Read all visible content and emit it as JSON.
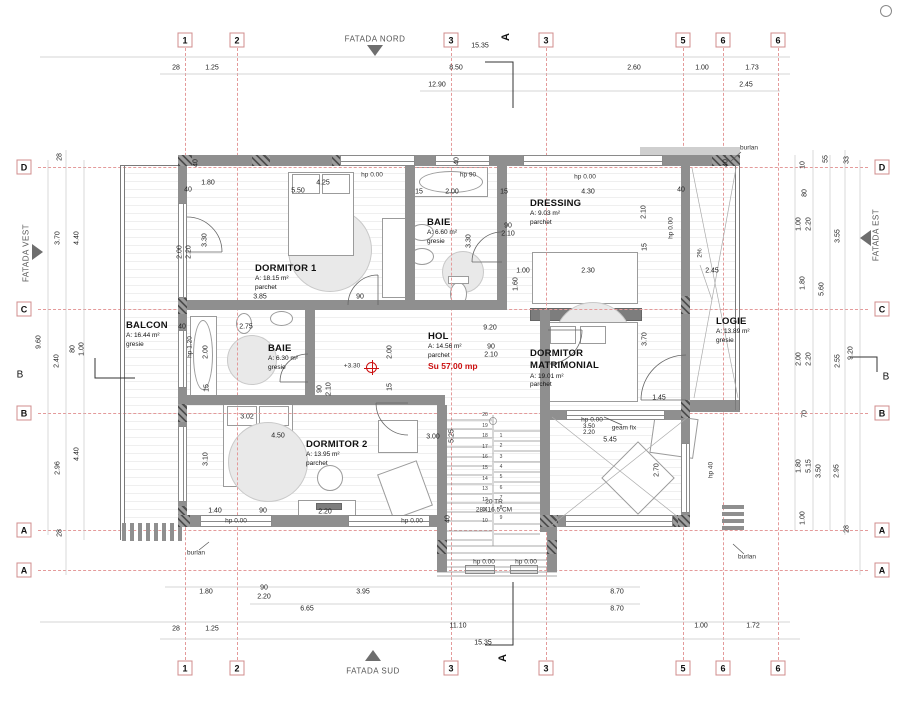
{
  "facades": {
    "north": "FATADA NORD",
    "south": "FATADA SUD",
    "west": "FATADA VEST",
    "east": "FATADA EST"
  },
  "section": {
    "label": "A"
  },
  "rooms": [
    {
      "name": "DORMITOR 1",
      "area": "A: 18.15 m²",
      "finish": "parchet"
    },
    {
      "name": "BAIE",
      "area": "A: 6.60 m²",
      "finish": "gresie"
    },
    {
      "name": "DRESSING",
      "area": "A: 9.03 m²",
      "finish": "parchet"
    },
    {
      "name": "HOL",
      "area": "A: 14.56 m²",
      "finish": "parchet",
      "extra": "Su 57.00 mp"
    },
    {
      "name": "DORMITOR MATRIMONIAL",
      "area": "A: 19.01 m²",
      "finish": "parchet"
    },
    {
      "name": "DORMITOR 2",
      "area": "A: 13.95 m²",
      "finish": "parchet"
    },
    {
      "name": "BAIE",
      "area": "A: 6.30 m²",
      "finish": "gresie"
    },
    {
      "name": "BALCON",
      "area": "A: 16.44 m²",
      "finish": "gresie"
    },
    {
      "name": "LOGIE",
      "area": "A: 13.89 m²",
      "finish": "gresie"
    }
  ],
  "axes": {
    "v": [
      {
        "label": "1",
        "x": 185
      },
      {
        "label": "2",
        "x": 237
      },
      {
        "label": "3",
        "x": 451
      },
      {
        "label": "3",
        "x": 546
      },
      {
        "label": "5",
        "x": 683
      },
      {
        "label": "6",
        "x": 723
      },
      {
        "label": "6",
        "x": 778
      }
    ],
    "h": [
      {
        "label": "D",
        "y": 167
      },
      {
        "label": "C",
        "y": 309
      },
      {
        "label": "B",
        "y": 413
      },
      {
        "label": "A",
        "y": 530
      },
      {
        "label": "A",
        "y": 570
      }
    ],
    "plain": [
      {
        "label": "B",
        "x": 20,
        "y": 375
      },
      {
        "label": "B",
        "x": 886,
        "y": 377
      }
    ]
  },
  "stairs": {
    "left": [
      "20",
      "19",
      "18",
      "17",
      "16",
      "15",
      "14",
      "13",
      "12",
      "11",
      "10"
    ],
    "right": [
      "1",
      "2",
      "3",
      "4",
      "5",
      "6",
      "7",
      "8",
      "9"
    ]
  },
  "dims": [
    {
      "t": "15.35",
      "x": 480,
      "y": 46
    },
    {
      "t": "28",
      "x": 176,
      "y": 68
    },
    {
      "t": "1.25",
      "x": 212,
      "y": 68
    },
    {
      "t": "8.50",
      "x": 456,
      "y": 68
    },
    {
      "t": "2.60",
      "x": 634,
      "y": 68
    },
    {
      "t": "1.00",
      "x": 702,
      "y": 68
    },
    {
      "t": "1.73",
      "x": 752,
      "y": 68
    },
    {
      "t": "12.90",
      "x": 437,
      "y": 85
    },
    {
      "t": "2.45",
      "x": 746,
      "y": 85
    },
    {
      "t": "1.80",
      "x": 206,
      "y": 592
    },
    {
      "t": "90",
      "x": 264,
      "y": 588
    },
    {
      "t": "2.20",
      "x": 264,
      "y": 597
    },
    {
      "t": "3.95",
      "x": 363,
      "y": 592
    },
    {
      "t": "8.70",
      "x": 617,
      "y": 592
    },
    {
      "t": "6.65",
      "x": 307,
      "y": 609
    },
    {
      "t": "8.70",
      "x": 617,
      "y": 609
    },
    {
      "t": "28",
      "x": 176,
      "y": 629
    },
    {
      "t": "1.25",
      "x": 212,
      "y": 629
    },
    {
      "t": "11.10",
      "x": 458,
      "y": 626
    },
    {
      "t": "1.00",
      "x": 701,
      "y": 626
    },
    {
      "t": "1.72",
      "x": 753,
      "y": 626
    },
    {
      "t": "15.35",
      "x": 483,
      "y": 643
    },
    {
      "t": "28",
      "x": 60,
      "y": 157,
      "r": 1
    },
    {
      "t": "3.70",
      "x": 58,
      "y": 238,
      "r": 1
    },
    {
      "t": "4.40",
      "x": 77,
      "y": 238,
      "r": 1
    },
    {
      "t": "9.60",
      "x": 39,
      "y": 342,
      "r": 1
    },
    {
      "t": "2.40",
      "x": 57,
      "y": 361,
      "r": 1
    },
    {
      "t": "80",
      "x": 73,
      "y": 349,
      "r": 1
    },
    {
      "t": "1.00",
      "x": 82,
      "y": 349,
      "r": 1
    },
    {
      "t": "2.96",
      "x": 58,
      "y": 468,
      "r": 1
    },
    {
      "t": "4.40",
      "x": 77,
      "y": 454,
      "r": 1
    },
    {
      "t": "28",
      "x": 60,
      "y": 533,
      "r": 1
    },
    {
      "t": "10",
      "x": 803,
      "y": 165,
      "r": 1
    },
    {
      "t": "55",
      "x": 826,
      "y": 159,
      "r": 1
    },
    {
      "t": "33",
      "x": 847,
      "y": 160,
      "r": 1
    },
    {
      "t": "80",
      "x": 805,
      "y": 193,
      "r": 1
    },
    {
      "t": "1.00",
      "x": 799,
      "y": 224,
      "r": 1
    },
    {
      "t": "2.20",
      "x": 809,
      "y": 224,
      "r": 1
    },
    {
      "t": "3.55",
      "x": 838,
      "y": 236,
      "r": 1
    },
    {
      "t": "1.80",
      "x": 803,
      "y": 283,
      "r": 1
    },
    {
      "t": "5.60",
      "x": 822,
      "y": 289,
      "r": 1
    },
    {
      "t": "2.00",
      "x": 799,
      "y": 359,
      "r": 1
    },
    {
      "t": "2.20",
      "x": 809,
      "y": 359,
      "r": 1
    },
    {
      "t": "2.55",
      "x": 838,
      "y": 361,
      "r": 1
    },
    {
      "t": "9.20",
      "x": 851,
      "y": 353,
      "r": 1
    },
    {
      "t": "70",
      "x": 805,
      "y": 414,
      "r": 1
    },
    {
      "t": "1.80",
      "x": 799,
      "y": 466,
      "r": 1
    },
    {
      "t": "5.15",
      "x": 809,
      "y": 466,
      "r": 1
    },
    {
      "t": "3.50",
      "x": 819,
      "y": 471,
      "r": 1
    },
    {
      "t": "2.95",
      "x": 837,
      "y": 471,
      "r": 1
    },
    {
      "t": "1.00",
      "x": 803,
      "y": 518,
      "r": 1
    },
    {
      "t": "28",
      "x": 847,
      "y": 529,
      "r": 1
    },
    {
      "t": "5.50",
      "x": 298,
      "y": 191
    },
    {
      "t": "1.80",
      "x": 208,
      "y": 183
    },
    {
      "t": "4.25",
      "x": 323,
      "y": 183
    },
    {
      "t": "3.30",
      "x": 205,
      "y": 240,
      "r": 1
    },
    {
      "t": "2.00",
      "x": 180,
      "y": 252,
      "r": 1
    },
    {
      "t": "2.20",
      "x": 189,
      "y": 252,
      "r": 1
    },
    {
      "t": "3.85",
      "x": 260,
      "y": 297
    },
    {
      "t": "90",
      "x": 360,
      "y": 297
    },
    {
      "t": "40",
      "x": 188,
      "y": 190
    },
    {
      "t": "15",
      "x": 419,
      "y": 192
    },
    {
      "t": "2.00",
      "x": 452,
      "y": 192
    },
    {
      "t": "15",
      "x": 504,
      "y": 192
    },
    {
      "t": "3.30",
      "x": 469,
      "y": 241,
      "r": 1
    },
    {
      "t": "90",
      "x": 508,
      "y": 226
    },
    {
      "t": "2.10",
      "x": 508,
      "y": 234
    },
    {
      "t": "4.30",
      "x": 588,
      "y": 192
    },
    {
      "t": "2.10",
      "x": 644,
      "y": 212,
      "r": 1
    },
    {
      "t": "15",
      "x": 645,
      "y": 247,
      "r": 1
    },
    {
      "t": "1.00",
      "x": 523,
      "y": 271
    },
    {
      "t": "2.30",
      "x": 588,
      "y": 271
    },
    {
      "t": "1.60",
      "x": 516,
      "y": 284,
      "r": 1
    },
    {
      "t": "9.20",
      "x": 490,
      "y": 328
    },
    {
      "t": "2.00",
      "x": 390,
      "y": 352,
      "r": 1
    },
    {
      "t": "15",
      "x": 390,
      "y": 387,
      "r": 1
    },
    {
      "t": "90",
      "x": 491,
      "y": 347
    },
    {
      "t": "2.10",
      "x": 491,
      "y": 355
    },
    {
      "t": "90",
      "x": 320,
      "y": 389,
      "r": 1
    },
    {
      "t": "2.10",
      "x": 329,
      "y": 389,
      "r": 1
    },
    {
      "t": "2.75",
      "x": 246,
      "y": 327
    },
    {
      "t": "2.00",
      "x": 206,
      "y": 352,
      "r": 1
    },
    {
      "t": "15",
      "x": 207,
      "y": 388,
      "r": 1
    },
    {
      "t": "4.50",
      "x": 278,
      "y": 436
    },
    {
      "t": "3.10",
      "x": 206,
      "y": 459,
      "r": 1
    },
    {
      "t": "3.02",
      "x": 247,
      "y": 417
    },
    {
      "t": "1.40",
      "x": 215,
      "y": 511
    },
    {
      "t": "90",
      "x": 263,
      "y": 511
    },
    {
      "t": "2.20",
      "x": 325,
      "y": 512
    },
    {
      "t": "3.00",
      "x": 433,
      "y": 437
    },
    {
      "t": "5.25",
      "x": 452,
      "y": 436,
      "r": 1
    },
    {
      "t": "3.50",
      "x": 589,
      "y": 427,
      "fs": 1
    },
    {
      "t": "2.20",
      "x": 589,
      "y": 433,
      "fs": 1
    },
    {
      "t": "5.45",
      "x": 610,
      "y": 440
    },
    {
      "t": "3.70",
      "x": 645,
      "y": 339,
      "r": 1
    },
    {
      "t": "2.45",
      "x": 712,
      "y": 271
    },
    {
      "t": "1.45",
      "x": 659,
      "y": 398
    },
    {
      "t": "2.70",
      "x": 657,
      "y": 470,
      "r": 1
    },
    {
      "t": "40",
      "x": 196,
      "y": 163,
      "r": 1
    },
    {
      "t": "40",
      "x": 457,
      "y": 161,
      "r": 1
    },
    {
      "t": "40",
      "x": 681,
      "y": 190
    },
    {
      "t": "40",
      "x": 726,
      "y": 163,
      "r": 1
    },
    {
      "t": "40",
      "x": 448,
      "y": 519,
      "r": 1
    },
    {
      "t": "40",
      "x": 182,
      "y": 327
    }
  ],
  "notes": [
    {
      "t": "hp 0.00",
      "x": 372,
      "y": 175
    },
    {
      "t": "hp 0.00",
      "x": 585,
      "y": 177
    },
    {
      "t": "hp 90",
      "x": 468,
      "y": 175
    },
    {
      "t": "hp 0.00",
      "x": 592,
      "y": 420
    },
    {
      "t": "geam fix",
      "x": 624,
      "y": 428
    },
    {
      "t": "hp 0.00",
      "x": 236,
      "y": 521
    },
    {
      "t": "hp 0.00",
      "x": 412,
      "y": 521
    },
    {
      "t": "hp 0.00",
      "x": 484,
      "y": 562
    },
    {
      "t": "hp 0.00",
      "x": 526,
      "y": 562
    },
    {
      "t": "hp 40",
      "x": 711,
      "y": 470,
      "r": 1
    },
    {
      "t": "hp 1.20",
      "x": 190,
      "y": 347,
      "r": 1
    },
    {
      "t": "hp 0.00",
      "x": 671,
      "y": 228,
      "r": 1
    },
    {
      "t": "burlan",
      "x": 749,
      "y": 148
    },
    {
      "t": "burlan",
      "x": 747,
      "y": 557
    },
    {
      "t": "burlan",
      "x": 196,
      "y": 553
    },
    {
      "t": "+3.30",
      "x": 352,
      "y": 366
    },
    {
      "t": "2%",
      "x": 700,
      "y": 253,
      "r": 1
    },
    {
      "t": "20 TR",
      "x": 494,
      "y": 502
    },
    {
      "t": "28X16.5 CM",
      "x": 494,
      "y": 510
    }
  ],
  "walls": [
    {
      "x": 178,
      "y": 155,
      "w": 562,
      "h": 11
    },
    {
      "x": 178,
      "y": 166,
      "w": 9,
      "h": 361
    },
    {
      "x": 681,
      "y": 166,
      "w": 9,
      "h": 361
    },
    {
      "x": 178,
      "y": 515,
      "w": 269,
      "h": 12
    },
    {
      "x": 550,
      "y": 515,
      "w": 140,
      "h": 12
    },
    {
      "x": 437,
      "y": 405,
      "w": 10,
      "h": 167
    },
    {
      "x": 540,
      "y": 310,
      "w": 10,
      "h": 222
    },
    {
      "x": 547,
      "y": 527,
      "w": 10,
      "h": 45
    },
    {
      "x": 186,
      "y": 300,
      "w": 321,
      "h": 10
    },
    {
      "x": 405,
      "y": 166,
      "w": 10,
      "h": 134
    },
    {
      "x": 497,
      "y": 166,
      "w": 10,
      "h": 144
    },
    {
      "x": 186,
      "y": 395,
      "w": 259,
      "h": 10
    },
    {
      "x": 305,
      "y": 310,
      "w": 10,
      "h": 95
    },
    {
      "x": 550,
      "y": 410,
      "w": 16,
      "h": 10
    },
    {
      "x": 665,
      "y": 410,
      "w": 16,
      "h": 10
    },
    {
      "x": 690,
      "y": 400,
      "w": 50,
      "h": 12
    },
    {
      "x": 640,
      "y": 147,
      "w": 100,
      "h": 8,
      "c": 2
    },
    {
      "x": 252,
      "y": 155,
      "w": 18,
      "h": 11,
      "c": 1
    },
    {
      "x": 332,
      "y": 155,
      "w": 18,
      "h": 11,
      "c": 1
    },
    {
      "x": 443,
      "y": 155,
      "w": 18,
      "h": 11,
      "c": 1
    },
    {
      "x": 538,
      "y": 155,
      "w": 18,
      "h": 11,
      "c": 1
    },
    {
      "x": 628,
      "y": 155,
      "w": 18,
      "h": 11,
      "c": 1
    },
    {
      "x": 712,
      "y": 155,
      "w": 18,
      "h": 11,
      "c": 1
    },
    {
      "x": 178,
      "y": 155,
      "w": 14,
      "h": 11,
      "c": 1
    },
    {
      "x": 726,
      "y": 155,
      "w": 14,
      "h": 11,
      "c": 1
    },
    {
      "x": 178,
      "y": 296,
      "w": 9,
      "h": 18,
      "c": 1
    },
    {
      "x": 178,
      "y": 404,
      "w": 9,
      "h": 18,
      "c": 1
    },
    {
      "x": 178,
      "y": 506,
      "w": 9,
      "h": 18,
      "c": 1
    },
    {
      "x": 681,
      "y": 296,
      "w": 9,
      "h": 18,
      "c": 1
    },
    {
      "x": 681,
      "y": 400,
      "w": 9,
      "h": 18,
      "c": 1
    },
    {
      "x": 240,
      "y": 515,
      "w": 18,
      "h": 12,
      "c": 1
    },
    {
      "x": 352,
      "y": 515,
      "w": 18,
      "h": 12,
      "c": 1
    },
    {
      "x": 660,
      "y": 515,
      "w": 18,
      "h": 12,
      "c": 1
    },
    {
      "x": 178,
      "y": 515,
      "w": 12,
      "h": 12,
      "c": 1
    },
    {
      "x": 678,
      "y": 515,
      "w": 12,
      "h": 12,
      "c": 1
    },
    {
      "x": 437,
      "y": 540,
      "w": 10,
      "h": 14,
      "c": 1
    },
    {
      "x": 547,
      "y": 540,
      "w": 10,
      "h": 14,
      "c": 1
    },
    {
      "x": 540,
      "y": 515,
      "w": 18,
      "h": 12,
      "c": 1
    },
    {
      "x": 120,
      "y": 165,
      "w": 1,
      "h": 375,
      "t": 1
    },
    {
      "x": 124,
      "y": 165,
      "w": 1,
      "h": 375,
      "t": 1
    },
    {
      "x": 120,
      "y": 165,
      "w": 58,
      "h": 1,
      "t": 1
    },
    {
      "x": 735,
      "y": 155,
      "w": 1,
      "h": 255,
      "t": 1
    },
    {
      "x": 739,
      "y": 155,
      "w": 1,
      "h": 255,
      "t": 1
    },
    {
      "x": 122,
      "y": 523,
      "w": 4,
      "h": 18
    },
    {
      "x": 130,
      "y": 523,
      "w": 4,
      "h": 18
    },
    {
      "x": 138,
      "y": 523,
      "w": 4,
      "h": 18
    },
    {
      "x": 146,
      "y": 523,
      "w": 4,
      "h": 18
    },
    {
      "x": 154,
      "y": 523,
      "w": 4,
      "h": 18
    },
    {
      "x": 162,
      "y": 523,
      "w": 4,
      "h": 18
    },
    {
      "x": 170,
      "y": 523,
      "w": 4,
      "h": 18
    },
    {
      "x": 178,
      "y": 523,
      "w": 4,
      "h": 18
    },
    {
      "x": 722,
      "y": 505,
      "w": 22,
      "h": 4
    },
    {
      "x": 722,
      "y": 512,
      "w": 22,
      "h": 4
    },
    {
      "x": 722,
      "y": 519,
      "w": 22,
      "h": 4
    },
    {
      "x": 722,
      "y": 526,
      "w": 22,
      "h": 4
    }
  ],
  "windows": [
    {
      "x": 340,
      "y": 155,
      "w": 75,
      "h": 11,
      "o": "h"
    },
    {
      "x": 435,
      "y": 155,
      "w": 55,
      "h": 11,
      "o": "h"
    },
    {
      "x": 523,
      "y": 155,
      "w": 140,
      "h": 11,
      "o": "h"
    },
    {
      "x": 178,
      "y": 203,
      "w": 9,
      "h": 95,
      "o": "v"
    },
    {
      "x": 178,
      "y": 330,
      "w": 9,
      "h": 58,
      "o": "v"
    },
    {
      "x": 178,
      "y": 426,
      "w": 9,
      "h": 76,
      "o": "v"
    },
    {
      "x": 200,
      "y": 515,
      "w": 72,
      "h": 12,
      "o": "h"
    },
    {
      "x": 348,
      "y": 515,
      "w": 82,
      "h": 12,
      "o": "h"
    },
    {
      "x": 565,
      "y": 515,
      "w": 108,
      "h": 12,
      "o": "h"
    },
    {
      "x": 566,
      "y": 410,
      "w": 99,
      "h": 10,
      "o": "h"
    },
    {
      "x": 681,
      "y": 443,
      "w": 9,
      "h": 70,
      "o": "v"
    },
    {
      "x": 465,
      "y": 565,
      "w": 30,
      "h": 9,
      "o": "h"
    },
    {
      "x": 510,
      "y": 565,
      "w": 28,
      "h": 9,
      "o": "h"
    }
  ],
  "furniture": [
    {
      "k": "circ",
      "x": 288,
      "y": 208,
      "w": 84,
      "h": 84,
      "f": 1
    },
    {
      "k": "rect",
      "x": 288,
      "y": 172,
      "w": 66,
      "h": 84
    },
    {
      "k": "rect",
      "x": 292,
      "y": 174,
      "w": 28,
      "h": 20
    },
    {
      "k": "rect",
      "x": 322,
      "y": 174,
      "w": 28,
      "h": 20
    },
    {
      "k": "rect",
      "x": 382,
      "y": 218,
      "w": 24,
      "h": 80
    },
    {
      "k": "rect",
      "x": 414,
      "y": 167,
      "w": 74,
      "h": 30
    },
    {
      "k": "circ",
      "x": 419,
      "y": 171,
      "w": 64,
      "h": 22
    },
    {
      "k": "circ",
      "x": 410,
      "y": 224,
      "w": 24,
      "h": 17
    },
    {
      "k": "circ",
      "x": 410,
      "y": 248,
      "w": 24,
      "h": 17
    },
    {
      "k": "circ",
      "x": 442,
      "y": 251,
      "w": 42,
      "h": 42,
      "f": 1
    },
    {
      "k": "circ",
      "x": 450,
      "y": 282,
      "w": 17,
      "h": 24
    },
    {
      "k": "rect",
      "x": 448,
      "y": 276,
      "w": 21,
      "h": 8
    },
    {
      "k": "rect",
      "x": 532,
      "y": 252,
      "w": 106,
      "h": 52
    },
    {
      "k": "rect",
      "x": 530,
      "y": 308,
      "w": 112,
      "h": 13,
      "f": 2
    },
    {
      "k": "circ",
      "x": 554,
      "y": 302,
      "w": 78,
      "h": 78,
      "f": 1
    },
    {
      "k": "rect",
      "x": 546,
      "y": 322,
      "w": 92,
      "h": 80
    },
    {
      "k": "rect",
      "x": 550,
      "y": 326,
      "w": 26,
      "h": 18
    },
    {
      "k": "rect",
      "x": 580,
      "y": 326,
      "w": 26,
      "h": 18
    },
    {
      "k": "rect",
      "x": 190,
      "y": 316,
      "w": 27,
      "h": 80
    },
    {
      "k": "circ",
      "x": 193,
      "y": 320,
      "w": 20,
      "h": 70
    },
    {
      "k": "circ",
      "x": 227,
      "y": 335,
      "w": 50,
      "h": 50,
      "f": 1
    },
    {
      "k": "circ",
      "x": 270,
      "y": 311,
      "w": 23,
      "h": 15
    },
    {
      "k": "circ",
      "x": 236,
      "y": 313,
      "w": 16,
      "h": 21
    },
    {
      "k": "rect",
      "x": 223,
      "y": 403,
      "w": 70,
      "h": 84
    },
    {
      "k": "rect",
      "x": 227,
      "y": 406,
      "w": 30,
      "h": 20
    },
    {
      "k": "rect",
      "x": 259,
      "y": 406,
      "w": 30,
      "h": 20
    },
    {
      "k": "circ",
      "x": 228,
      "y": 422,
      "w": 80,
      "h": 80,
      "f": 1
    },
    {
      "k": "rect",
      "x": 298,
      "y": 500,
      "w": 58,
      "h": 16
    },
    {
      "k": "rect",
      "x": 316,
      "y": 503,
      "w": 26,
      "h": 7,
      "f": 2
    },
    {
      "k": "circ",
      "x": 317,
      "y": 465,
      "w": 26,
      "h": 26
    },
    {
      "k": "rect",
      "x": 378,
      "y": 420,
      "w": 40,
      "h": 33
    },
    {
      "k": "rect",
      "x": 384,
      "y": 466,
      "w": 42,
      "h": 48,
      "rot": -20
    },
    {
      "k": "rect",
      "x": 612,
      "y": 452,
      "w": 52,
      "h": 52,
      "rot": 45
    },
    {
      "k": "rect",
      "x": 652,
      "y": 416,
      "w": 44,
      "h": 40,
      "rot": 8
    }
  ]
}
